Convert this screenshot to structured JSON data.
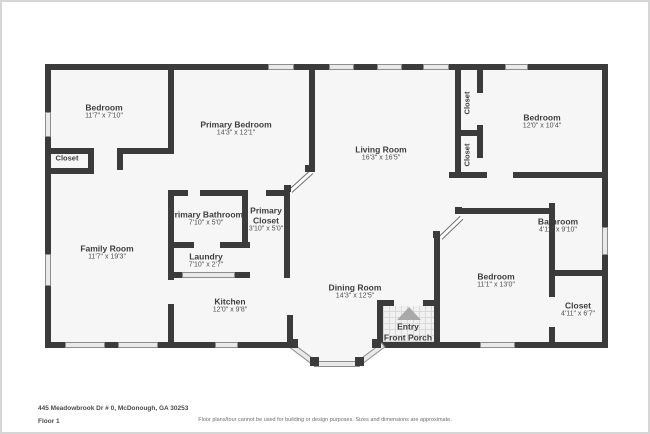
{
  "page": {
    "address": "445 Meadowbrook Dr # 0, McDonough, GA 30253",
    "floor_label": "Floor 1",
    "disclaimer": "Floor plans/tour cannot be used for building or design purposes. Sizes and dimensions are approximate."
  },
  "colors": {
    "wall": "#3b3b3b",
    "room_fill": "#f6f6f6",
    "window_fill": "#e9e9e9",
    "outside": "#ffffff",
    "label_text": "#3d3d3d",
    "entry_arrow": "#a9a9a9"
  },
  "rooms": [
    {
      "name": "Bedroom",
      "dims": "11'7\" x 7'10\""
    },
    {
      "name": "Closet",
      "dims": ""
    },
    {
      "name": "Primary Bedroom",
      "dims": "14'3\" x 12'1\""
    },
    {
      "name": "Living Room",
      "dims": "16'3\" x 16'5\""
    },
    {
      "name": "Closet",
      "dims": ""
    },
    {
      "name": "Closet",
      "dims": ""
    },
    {
      "name": "Bedroom",
      "dims": "12'0\" x 10'4\""
    },
    {
      "name": "Family Room",
      "dims": "11'7\" x 19'3\""
    },
    {
      "name": "Primary Bathroom",
      "dims": "7'10\" x 5'0\""
    },
    {
      "name": "Primary Closet",
      "dims": "3'10\" x 5'0\""
    },
    {
      "name": "Laundry",
      "dims": "7'10\" x 2'7\""
    },
    {
      "name": "Kitchen",
      "dims": "12'0\" x 9'8\""
    },
    {
      "name": "Dining Room",
      "dims": "14'3\" x 12'5\""
    },
    {
      "name": "Bedroom",
      "dims": "11'1\" x 13'0\""
    },
    {
      "name": "Bathroom",
      "dims": "4'11\" x 9'10\""
    },
    {
      "name": "Closet",
      "dims": "4'11\" x 6'7\""
    }
  ],
  "entry": {
    "line1": "Entry",
    "line2": "Front Porch"
  }
}
